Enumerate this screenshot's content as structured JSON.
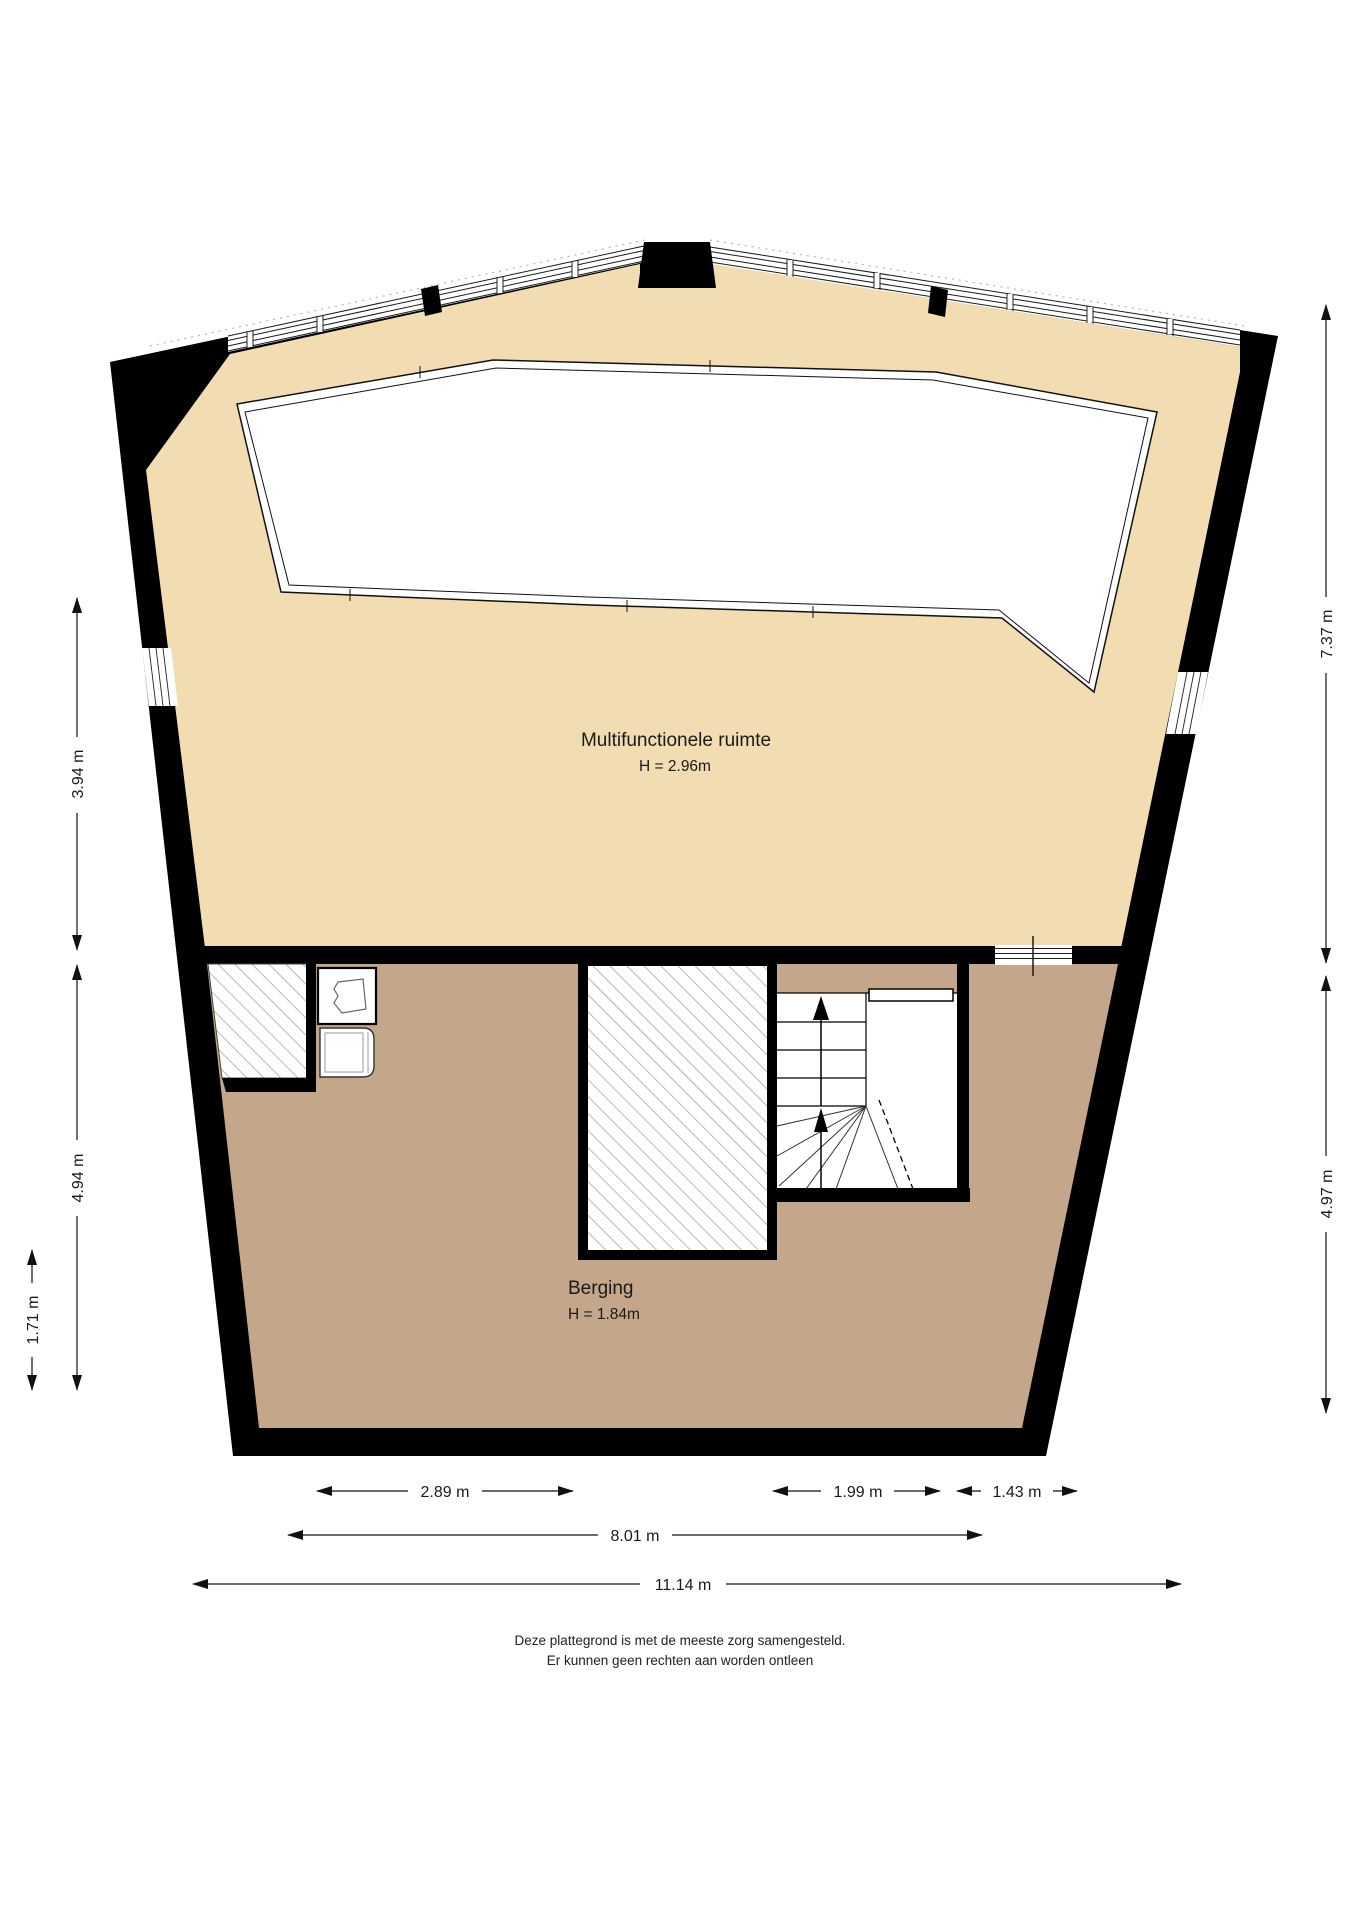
{
  "floorplan": {
    "rooms": {
      "multifunctional": {
        "name": "Multifunctionele ruimte",
        "height": "H = 2.96m"
      },
      "storage": {
        "name": "Berging",
        "height": "H = 1.84m"
      }
    },
    "dimensions": {
      "left_upper": "3.94 m",
      "left_lower": "4.94 m",
      "left_inner": "1.71 m",
      "right_upper": "7.37 m",
      "right_lower": "4.97 m",
      "bottom_left": "2.89 m",
      "bottom_mid": "1.99 m",
      "bottom_right": "1.43 m",
      "bottom_span": "8.01 m",
      "bottom_total": "11.14 m"
    },
    "footer": {
      "line1": "Deze plattegrond is met de meeste zorg samengesteld.",
      "line2": "Er kunnen geen rechten aan worden ontleen"
    },
    "colors": {
      "upper_floor": "#f2dcb2",
      "lower_floor": "#c4a78a",
      "wall": "#000000",
      "hatch_line": "#999999"
    }
  }
}
